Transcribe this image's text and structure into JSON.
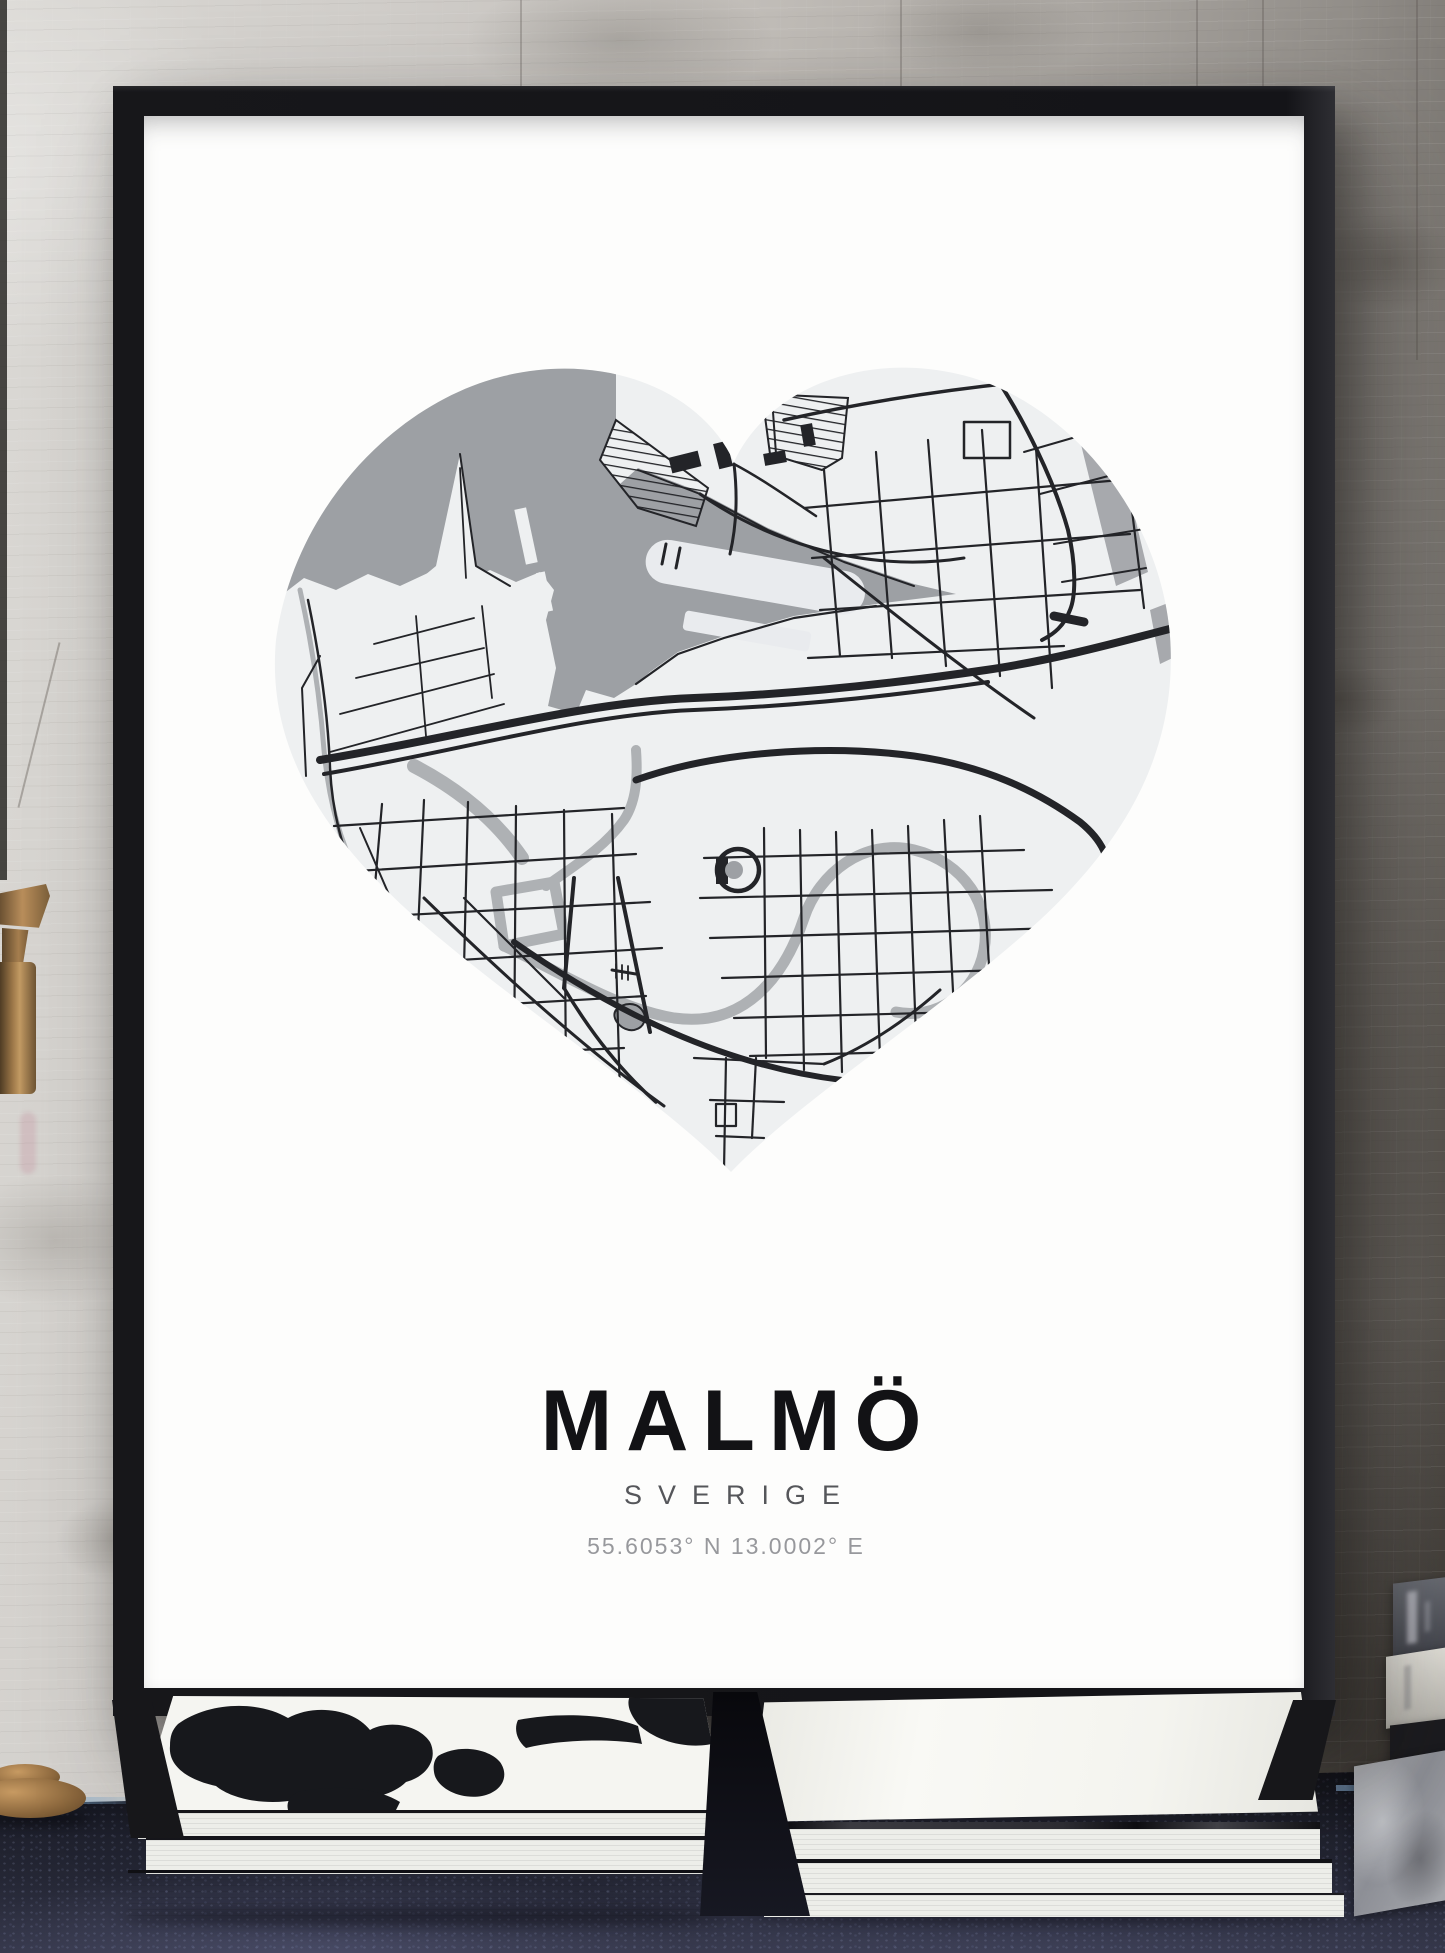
{
  "poster": {
    "city_title": "MALMÖ",
    "country_subtitle": "SVERIGE",
    "coordinates": "55.6053° N 13.0002° E"
  },
  "colors": {
    "poster_bg": "#fdfdfc",
    "frame": "#141418",
    "map_land": "#eef0f1",
    "map_water": "#9da0a4",
    "map_road": "#232428",
    "map_canal": "#aeb1b4",
    "wall_light": "#dbd9d5",
    "wall_dark": "#57534e",
    "table": "#242634",
    "table_edge_highlight": "#7da5c8",
    "brass": "#a57e4e",
    "book_pages": "#edeee9"
  }
}
